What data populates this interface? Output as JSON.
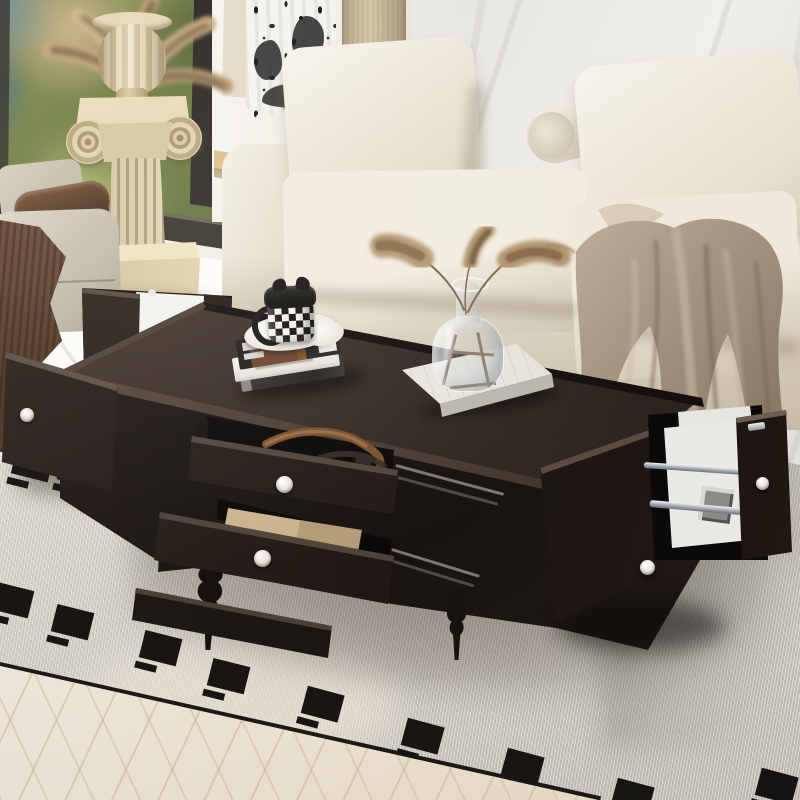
{
  "scene": {
    "type": "furniture-product-photo",
    "subject": "espresso coffee table with open storage drawers in a living room",
    "room": {
      "wall": "white marble",
      "window": "left side, dark frame, blurred greenery outside",
      "curtain": "white with black toile pattern",
      "floor": "cream herringbone wood",
      "rug": "off-white woven rug with black square motif border and black edge binding"
    },
    "furniture": {
      "coffee_table": {
        "finish": "dark espresso wood",
        "knob_style": "round white porcelain",
        "open_parts": [
          "top drawer",
          "bottom drawer",
          "left side door",
          "right front door",
          "right pull-out magazine rack"
        ],
        "rack_rails": "chrome",
        "legs": "turned espresso wood"
      },
      "sofa": "ivory modular sofa with back cushions and bolster",
      "armchair": "greige armchair with dark wood arm and brown fringed throw",
      "pedestal": "classical ionic column with gadrooned urn of dried palm fronds"
    },
    "props": {
      "on_table": [
        "stack of three books",
        "white saucer",
        "black-and-white checkered mug with black cat-ear lid",
        "white marble tray",
        "glass vase with pampas grass on wire stand"
      ],
      "in_top_drawer": "brown leather belt",
      "in_bottom_drawer": "kraft paper envelopes",
      "in_rack": "white magazines",
      "on_sofa": "taupe satin throw blanket"
    }
  },
  "palette": {
    "espresso1": "#342a23",
    "espresso2": "#1e1713",
    "espresso3": "#0d0a08",
    "knob": "#efebe4",
    "ivory1": "#f4f0e6",
    "ivory2": "#d8d0bd",
    "taupe1": "#b3a08d",
    "taupe2": "#8d7a68",
    "rugblack": "#141210",
    "marble1": "#f0eeea",
    "wood1": "#e2cb9b",
    "wood2": "#caa870",
    "dthrow1": "#6b4c37",
    "dthrow2": "#452f22",
    "belt": "#7d5531",
    "chrome": "#9aa0a6",
    "curtain_black": "#1a1a1a",
    "floor_cream": "#f3e9d5"
  },
  "rug": {
    "square_size": [
      38,
      28
    ],
    "dash_size": [
      22,
      7
    ],
    "squares": [
      {
        "x": 12,
        "y": 60,
        "r": 14
      },
      {
        "x": 58,
        "y": 66,
        "r": 14
      },
      {
        "x": -8,
        "y": 196,
        "r": 14
      },
      {
        "x": 52,
        "y": 218,
        "r": 14
      },
      {
        "x": 140,
        "y": 244,
        "r": 14
      },
      {
        "x": 208,
        "y": 272,
        "r": 14
      },
      {
        "x": 302,
        "y": 300,
        "r": 15
      },
      {
        "x": 402,
        "y": 332,
        "r": 15
      },
      {
        "x": 502,
        "y": 362,
        "r": 15
      },
      {
        "x": 612,
        "y": 392,
        "r": 15
      },
      {
        "x": 756,
        "y": 382,
        "r": 15
      }
    ]
  }
}
